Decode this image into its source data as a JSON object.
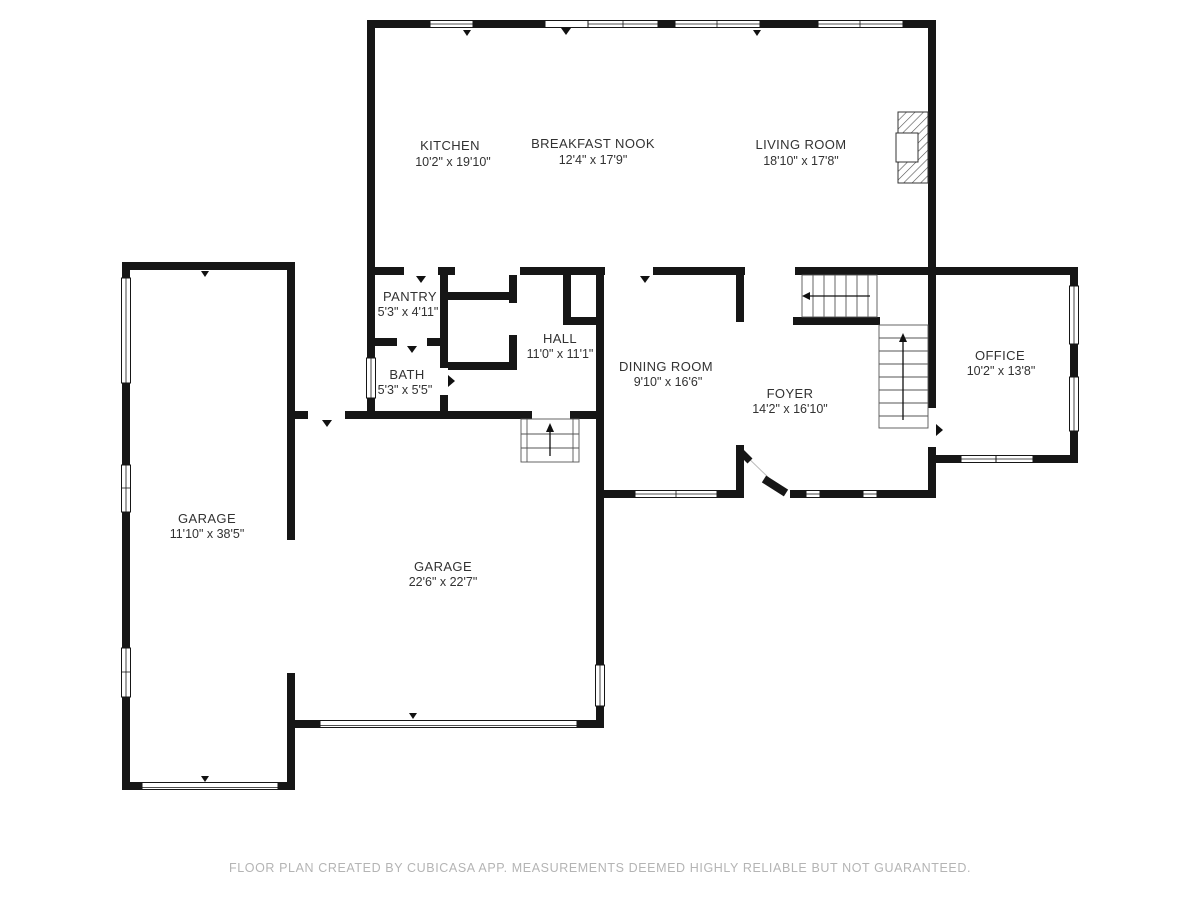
{
  "footer": {
    "text": "FLOOR PLAN CREATED BY CUBICASA APP. MEASUREMENTS DEEMED HIGHLY RELIABLE BUT NOT GUARANTEED."
  },
  "colors": {
    "wall": "#161616",
    "background": "#ffffff",
    "label_text": "#323232",
    "footer_text": "#b4b4b4"
  },
  "rooms": {
    "kitchen": {
      "name": "KITCHEN",
      "dims": "10'2\" x 19'10\""
    },
    "breakfast_nook": {
      "name": "BREAKFAST NOOK",
      "dims": "12'4\" x 17'9\""
    },
    "living_room": {
      "name": "LIVING ROOM",
      "dims": "18'10\" x 17'8\""
    },
    "pantry": {
      "name": "PANTRY",
      "dims": "5'3\" x 4'11\""
    },
    "hall": {
      "name": "HALL",
      "dims": "11'0\" x 11'1\""
    },
    "bath": {
      "name": "BATH",
      "dims": "5'3\" x 5'5\""
    },
    "dining_room": {
      "name": "DINING ROOM",
      "dims": "9'10\" x 16'6\""
    },
    "foyer": {
      "name": "FOYER",
      "dims": "14'2\" x 16'10\""
    },
    "office": {
      "name": "OFFICE",
      "dims": "10'2\" x 13'8\""
    },
    "garage_left": {
      "name": "GARAGE",
      "dims": "11'10\" x 38'5\""
    },
    "garage_main": {
      "name": "GARAGE",
      "dims": "22'6\" x 22'7\""
    }
  }
}
